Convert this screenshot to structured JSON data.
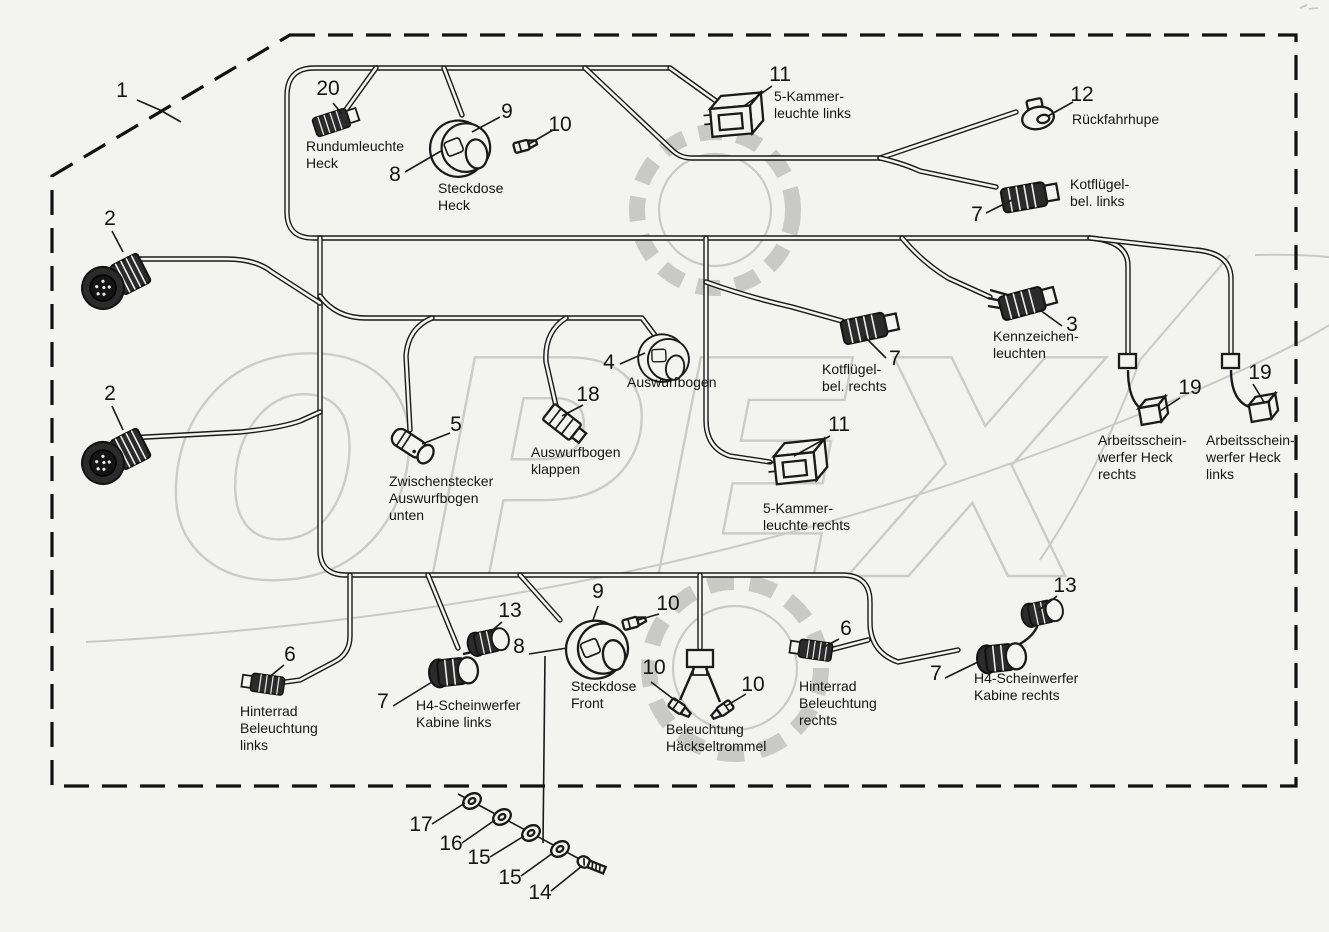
{
  "diagram": {
    "title": "Wiring loom parts diagram",
    "language": "de",
    "watermark_text": "OPEX",
    "background_color": "#f3f3ef",
    "line_color": "#1a1a1a",
    "watermark_color": "#c9c9c5",
    "boundary_style": "dashed"
  },
  "callouts": [
    {
      "num": "1",
      "nx": 122,
      "ny": 97
    },
    {
      "num": "20",
      "nx": 328,
      "ny": 95,
      "caption": [
        "Rundumleuchte",
        "Heck"
      ],
      "cx": 306,
      "cy": 151
    },
    {
      "num": "9",
      "nx": 507,
      "ny": 118
    },
    {
      "num": "10",
      "nx": 560,
      "ny": 131
    },
    {
      "num": "8",
      "nx": 395,
      "ny": 181,
      "caption": [
        "Steckdose",
        "Heck"
      ],
      "cx": 438,
      "cy": 193
    },
    {
      "num": "11",
      "nx": 780,
      "ny": 81,
      "caption": [
        "5-Kammer-",
        "leuchte links"
      ],
      "cx": 774,
      "cy": 101
    },
    {
      "num": "12",
      "nx": 1082,
      "ny": 101,
      "caption": [
        "Rückfahrhupe"
      ],
      "cx": 1072,
      "cy": 124
    },
    {
      "num": "7",
      "nx": 977,
      "ny": 221,
      "caption": [
        "Kotflügel-",
        "bel. links"
      ],
      "cx": 1070,
      "cy": 189
    },
    {
      "num": "2",
      "nx": 110,
      "ny": 225
    },
    {
      "num": "2",
      "nx": 110,
      "ny": 400
    },
    {
      "num": "4",
      "nx": 609,
      "ny": 369,
      "caption": [
        "Auswurfbogen"
      ],
      "cx": 627,
      "cy": 387
    },
    {
      "num": "18",
      "nx": 588,
      "ny": 401,
      "caption": [
        "Auswurfbogen",
        "klappen"
      ],
      "cx": 531,
      "cy": 457
    },
    {
      "num": "5",
      "nx": 456,
      "ny": 431,
      "caption": [
        "Zwischenstecker",
        "Auswurfbogen",
        "unten"
      ],
      "cx": 389,
      "cy": 486
    },
    {
      "num": "7",
      "nx": 895,
      "ny": 365,
      "caption": [
        "Kotflügel-",
        "bel. rechts"
      ],
      "cx": 822,
      "cy": 374
    },
    {
      "num": "3",
      "nx": 1072,
      "ny": 331,
      "caption": [
        "Kennzeichen-",
        "leuchten"
      ],
      "cx": 993,
      "cy": 341
    },
    {
      "num": "11",
      "nx": 839,
      "ny": 431,
      "caption": [
        "5-Kammer-",
        "leuchte rechts"
      ],
      "cx": 763,
      "cy": 513
    },
    {
      "num": "19",
      "nx": 1190,
      "ny": 394,
      "caption": [
        "Arbeitsschein-",
        "werfer Heck",
        "rechts"
      ],
      "cx": 1098,
      "cy": 445
    },
    {
      "num": "19",
      "nx": 1260,
      "ny": 379,
      "caption": [
        "Arbeitsschein-",
        "werfer Heck",
        "links"
      ],
      "cx": 1206,
      "cy": 445
    },
    {
      "num": "13",
      "nx": 510,
      "ny": 617
    },
    {
      "num": "9",
      "nx": 598,
      "ny": 598
    },
    {
      "num": "10",
      "nx": 668,
      "ny": 610
    },
    {
      "num": "8",
      "nx": 519,
      "ny": 653,
      "caption": [
        "Steckdose",
        "Front"
      ],
      "cx": 571,
      "cy": 691
    },
    {
      "num": "6",
      "nx": 290,
      "ny": 661,
      "caption": [
        "Hinterrad",
        "Beleuchtung",
        "links"
      ],
      "cx": 240,
      "cy": 716
    },
    {
      "num": "7",
      "nx": 383,
      "ny": 708,
      "caption": [
        "H4-Scheinwerfer",
        "Kabine links"
      ],
      "cx": 416,
      "cy": 710
    },
    {
      "num": "10",
      "nx": 654,
      "ny": 674
    },
    {
      "num": "10",
      "nx": 753,
      "ny": 691
    },
    {
      "num": "",
      "caption": [
        "Beleuchtung",
        "Häckseltrommel"
      ],
      "cx": 666,
      "cy": 734
    },
    {
      "num": "6",
      "nx": 846,
      "ny": 635,
      "caption": [
        "Hinterrad",
        "Beleuchtung",
        "rechts"
      ],
      "cx": 799,
      "cy": 691
    },
    {
      "num": "13",
      "nx": 1065,
      "ny": 592
    },
    {
      "num": "7",
      "nx": 936,
      "ny": 680,
      "caption": [
        "H4-Scheinwerfer",
        "Kabine rechts"
      ],
      "cx": 974,
      "cy": 683
    },
    {
      "num": "17",
      "nx": 421,
      "ny": 831
    },
    {
      "num": "16",
      "nx": 451,
      "ny": 850
    },
    {
      "num": "15",
      "nx": 479,
      "ny": 864
    },
    {
      "num": "15",
      "nx": 510,
      "ny": 884
    },
    {
      "num": "14",
      "nx": 540,
      "ny": 899
    }
  ]
}
